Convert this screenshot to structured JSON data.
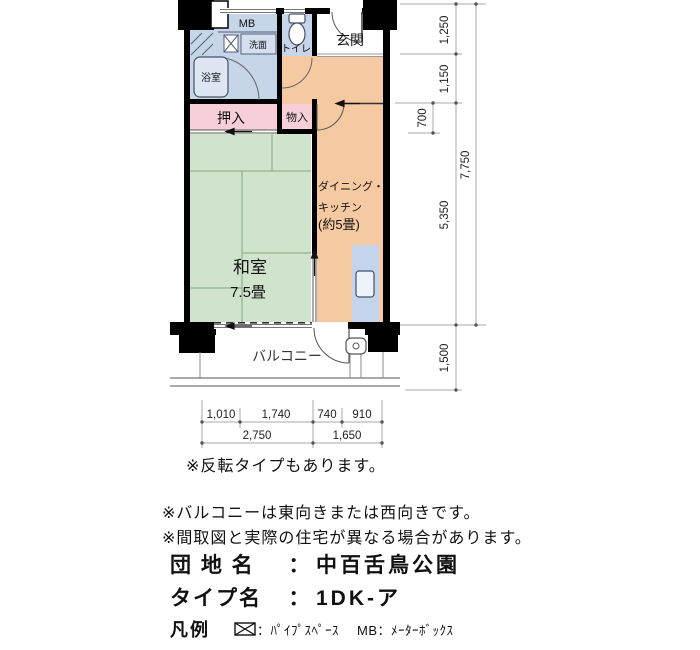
{
  "floorplan": {
    "rooms": {
      "mb": "MB",
      "washstand": "洗面",
      "bathroom": "浴室",
      "toilet": "トイレ",
      "entrance": "玄関",
      "closet": "押入",
      "storage": "物入",
      "japanese_room": "和室",
      "japanese_room_size": "7.5畳",
      "dk_line1": "ダイニング・",
      "dk_line2": "キッチン",
      "dk_line3": "(約5畳)",
      "balcony": "バルコニー"
    },
    "dimensions": {
      "right_top": "1,250",
      "right_upper": "1,150",
      "right_small": "700",
      "right_main": "5,350",
      "right_total": "7,750",
      "balcony_depth": "1,500",
      "bottom_1": "1,010",
      "bottom_2": "1,740",
      "bottom_3": "740",
      "bottom_4": "910",
      "bottom_left_total": "2,750",
      "bottom_right_total": "1,650"
    },
    "colors": {
      "dining_kitchen": "#f5c9a1",
      "japanese_room": "#cfe3cd",
      "wet_area": "#c7d5e9",
      "closet": "#f6cfd9",
      "counter": "#c3d4ec",
      "wall": "#000000"
    }
  },
  "notes": {
    "reverse_type": "※反転タイプもあります。",
    "balcony_facing": "※バルコニーは東向きまたは西向きです。",
    "disclaimer": "※間取図と実際の住宅が異なる場合があります。"
  },
  "property": {
    "estate_label": "団 地 名",
    "separator": "：",
    "estate_name": "中百舌鳥公園",
    "type_label": "タイプ名",
    "type_name": "1DK-ア"
  },
  "legend": {
    "title": "凡例",
    "pipe_space": "：ﾊﾟｲﾌﾟｽﾍﾟｰｽ",
    "meter_box": "MB：ﾒｰﾀｰﾎﾞｯｸｽ"
  }
}
